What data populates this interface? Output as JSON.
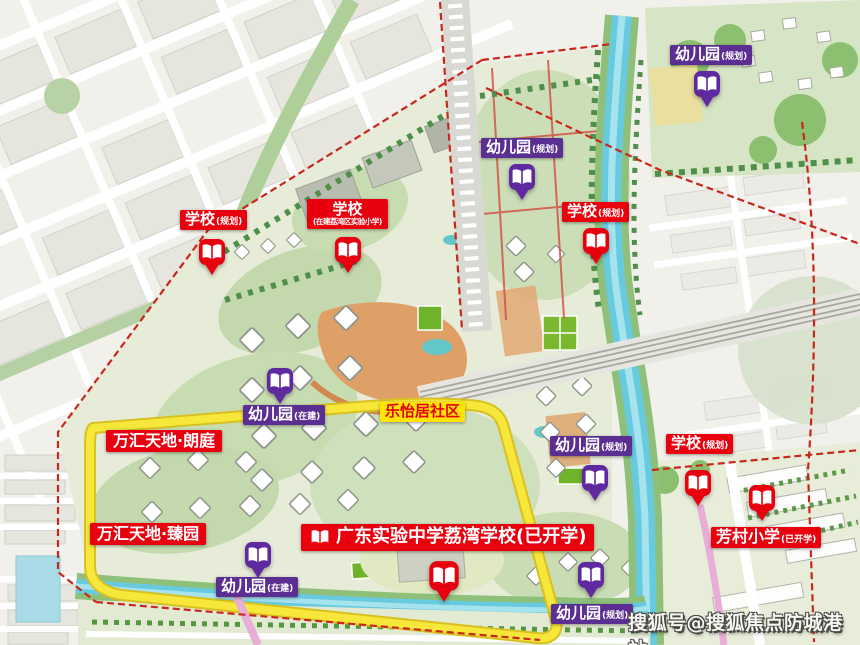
{
  "watermark": "搜狐号@搜狐焦点防城港站",
  "markers": {
    "kg_ne": {
      "text": "幼儿园",
      "sub": "(规划)"
    },
    "kg_nc": {
      "text": "幼儿园",
      "sub": "(规划)"
    },
    "sch_nc": {
      "text": "学校",
      "sub": "(规划)"
    },
    "sch_w": {
      "text": "学校",
      "sub": "(规划)"
    },
    "sch_w2": {
      "text": "学校",
      "sub": "(在建荔湾区实验小学)"
    },
    "kg_c": {
      "text": "幼儿园",
      "sub": "(在建)"
    },
    "community": {
      "text": "乐怡居社区"
    },
    "wanhui_lang": {
      "text": "万汇天地·朗庭"
    },
    "wanhui_zhen": {
      "text": "万汇天地·臻园"
    },
    "kg_sw": {
      "text": "幼儿园",
      "sub": "(在建)"
    },
    "gd_school": {
      "text": "广东实验中学荔湾学校(已开学)"
    },
    "kg_e": {
      "text": "幼儿园",
      "sub": "(规划)"
    },
    "sch_e": {
      "text": "学校",
      "sub": "(规划)"
    },
    "fangcun": {
      "text": "芳村小学",
      "sub": "(已开学)"
    },
    "kg_s": {
      "text": "幼儿园",
      "sub": "(规划)"
    }
  },
  "icons": {
    "pin": "open-book-location-pin",
    "label_book": "open-book-icon"
  },
  "colors": {
    "school_red": "#e8000e",
    "kindergarten_purple": "#5b2e91",
    "community_yellow": "#ffe400",
    "ring_road_yellow": "#f7e73b",
    "canal_blue": "#68cade",
    "boundary_red": "#c8281c",
    "park_green": "#c3d9ad"
  }
}
